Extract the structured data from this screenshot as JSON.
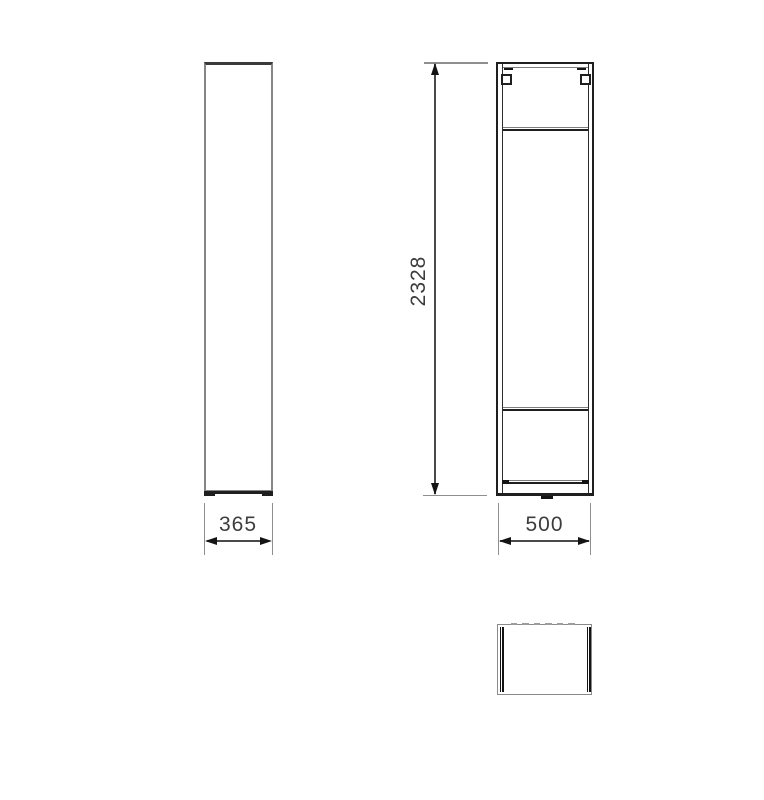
{
  "drawing": {
    "title": "tall-cabinet-technical-drawing",
    "views": [
      {
        "id": "side-view",
        "description": "tall narrow side elevation with plinth feet"
      },
      {
        "id": "front-view",
        "description": "front elevation, open carcass with top rail, hanger brackets, shelf line and plinth"
      },
      {
        "id": "top-view",
        "description": "plan view with side panel double lines and back-edge dashes"
      }
    ],
    "dimensions": {
      "side_width": "365",
      "front_height": "2328",
      "front_width": "500"
    },
    "colors": {
      "outline_gray": "#868686",
      "outline_dark": "#1f1f1f",
      "dimension_line": "#4a4a4a",
      "extension_line": "#8e8e8e",
      "arrow": "#141414",
      "label_text": "#3d3d3d",
      "background": "#ffffff"
    }
  }
}
